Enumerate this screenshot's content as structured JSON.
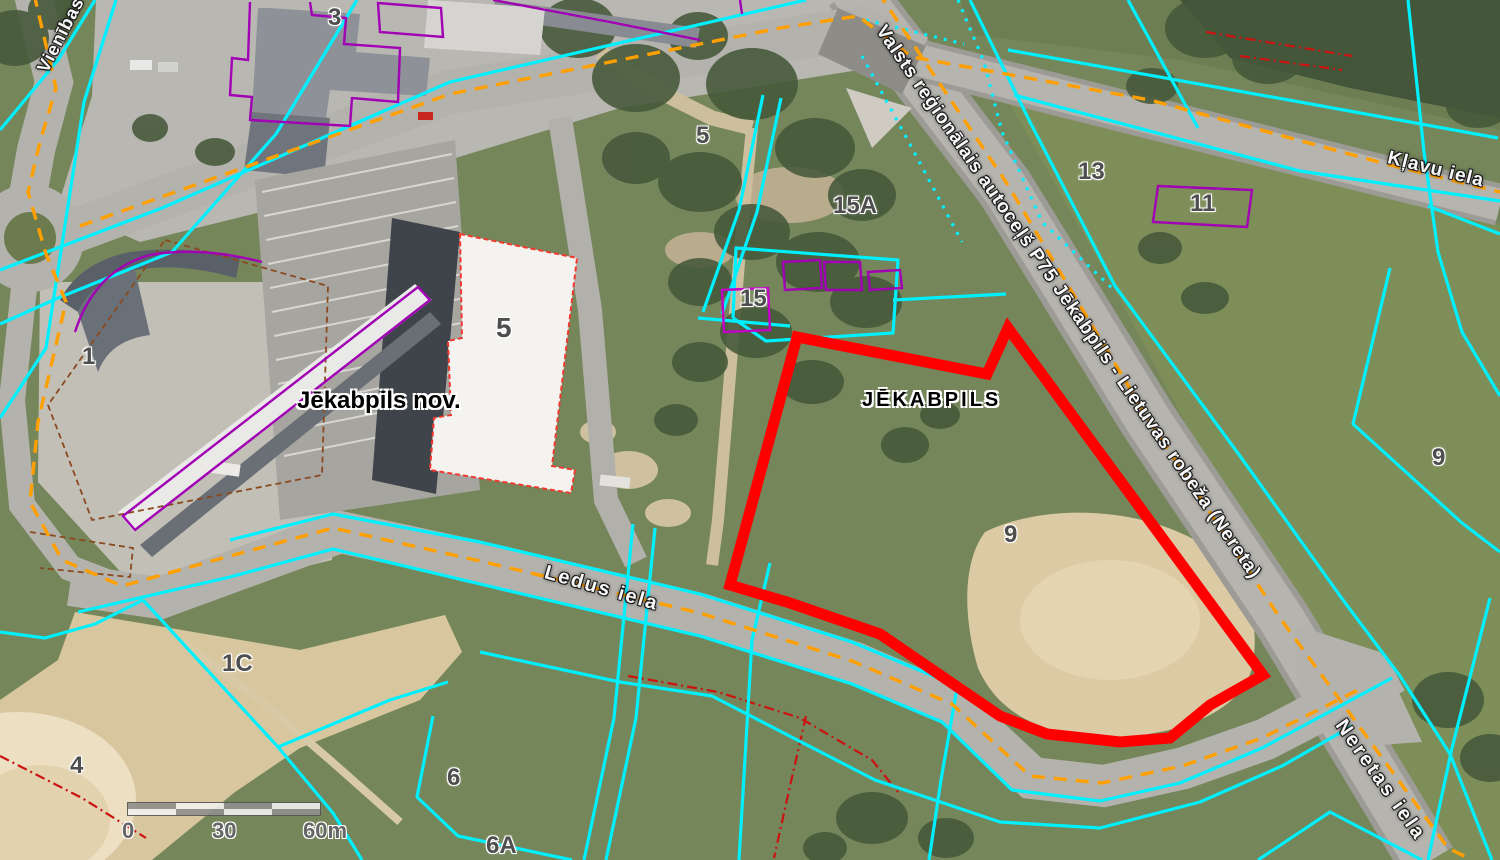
{
  "map": {
    "admin_labels": {
      "municipality": "Jēkabpils nov.",
      "city": "JĒKABPILS"
    },
    "street_labels": {
      "p75": "Valsts reģionālais autoceļš P75 Jēkabpils - Lietuvas robeža (Nereta)",
      "klavu": "Kļavu iela",
      "ledus": "Ledus iela",
      "neretas": "Neretas iela",
      "vienibas": "Vienības"
    },
    "parcel_numbers": {
      "n3": "3",
      "n5_top": "5",
      "n5_building": "5",
      "n15a": "15A",
      "n15": "15",
      "n13": "13",
      "n11": "11",
      "n9_right": "9",
      "n9_mid": "9",
      "n1c": "1C",
      "n4": "4",
      "n6": "6",
      "n6a": "6A",
      "n1": "1"
    },
    "scale_bar": {
      "tick0": "0",
      "tick30": "30",
      "tick60": "60m"
    },
    "colors": {
      "cadastral_boundary_cyan": "#00f0ff",
      "road_axis_orange": "#ffa000",
      "selected_parcel_red": "#ff0000",
      "building_outline_purple": "#a100b4",
      "building_outline_red": "#f3392f",
      "restriction_line_dark_red": "#cc1111",
      "lot_line_brown": "#8a4a20"
    }
  }
}
